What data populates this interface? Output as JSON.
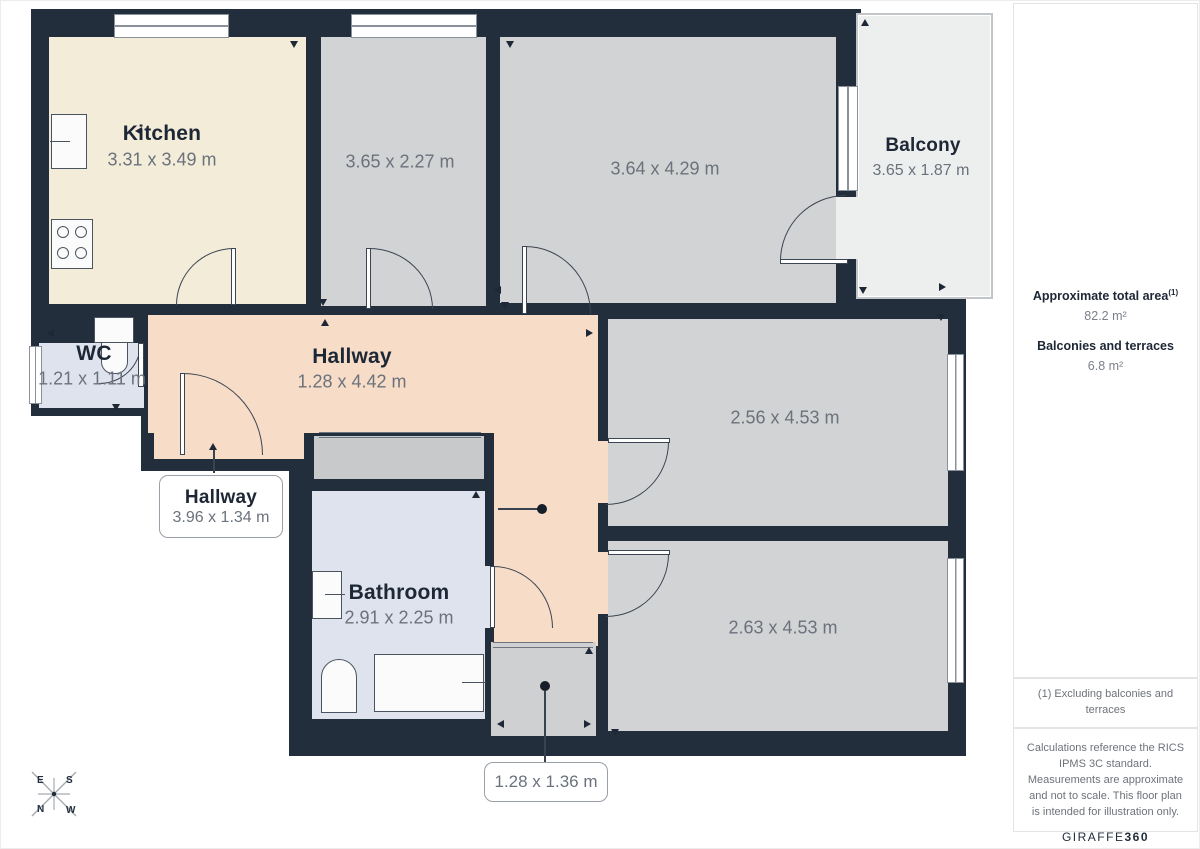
{
  "rooms": {
    "kitchen": {
      "label": "Kitchen",
      "dims": "3.31 x 3.49 m"
    },
    "room_a": {
      "dims": "3.65 x 2.27 m"
    },
    "room_b": {
      "dims": "3.64 x 4.29 m"
    },
    "balcony": {
      "label": "Balcony",
      "dims": "3.65 x 1.87 m"
    },
    "wc": {
      "label": "WC",
      "dims": "1.21 x 1.11 m"
    },
    "hallway": {
      "label": "Hallway",
      "dims": "1.28 x 4.42 m"
    },
    "hallway_lower": {
      "label": "Hallway",
      "dims": "3.96 x 1.34 m"
    },
    "bathroom": {
      "label": "Bathroom",
      "dims": "2.91 x 2.25 m"
    },
    "room_c": {
      "dims": "2.56 x 4.53 m"
    },
    "room_d": {
      "dims": "2.63 x 4.53 m"
    },
    "entrance": {
      "dims": "1.28 x 1.36 m"
    }
  },
  "sidebar": {
    "area_title": "Approximate total area",
    "area_footnote_marker": "(1)",
    "area_value": "82.2 m²",
    "balconies_title": "Balconies and terraces",
    "balconies_value": "6.8 m²",
    "footnote": "(1) Excluding balconies and terraces",
    "disclaimer": "Calculations reference the RICS IPMS 3C standard. Measurements are approximate and not to scale. This floor plan is intended for illustration only.",
    "brand_name": "GIRAFFE",
    "brand_number": "360"
  },
  "compass": {
    "n": "N",
    "s": "S",
    "e": "E",
    "w": "W"
  },
  "colors": {
    "wall": "#222e3c",
    "ink": "#1d2735",
    "dim": "#6b727c",
    "cream": "#f2ecd8",
    "gray": "#d2d3d4",
    "gray2": "#c8c9ca",
    "gray3": "#cfd0d1",
    "peach": "#f7dcc7",
    "bath": "#dfe3ee",
    "balc": "#edefee",
    "line": "#3c4552"
  }
}
